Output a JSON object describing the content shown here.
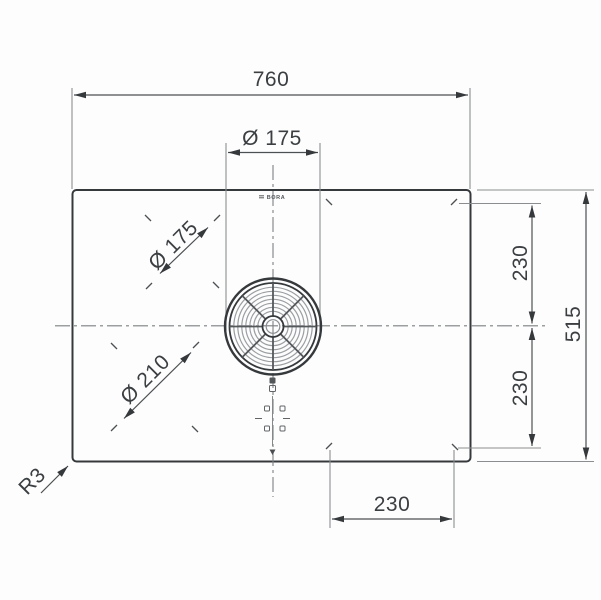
{
  "drawing": {
    "brand_logo": "BORA",
    "dims": {
      "overall_width": "760",
      "overall_depth": "515",
      "air_inlet_diameter": "Ø 175",
      "rear_left_zone_diameter": "Ø 175",
      "front_left_zone_diameter": "Ø 210",
      "rear_right_offset": "230",
      "front_right_offset": "230",
      "bottom_right_offset": "230",
      "corner_radius": "R3"
    }
  }
}
